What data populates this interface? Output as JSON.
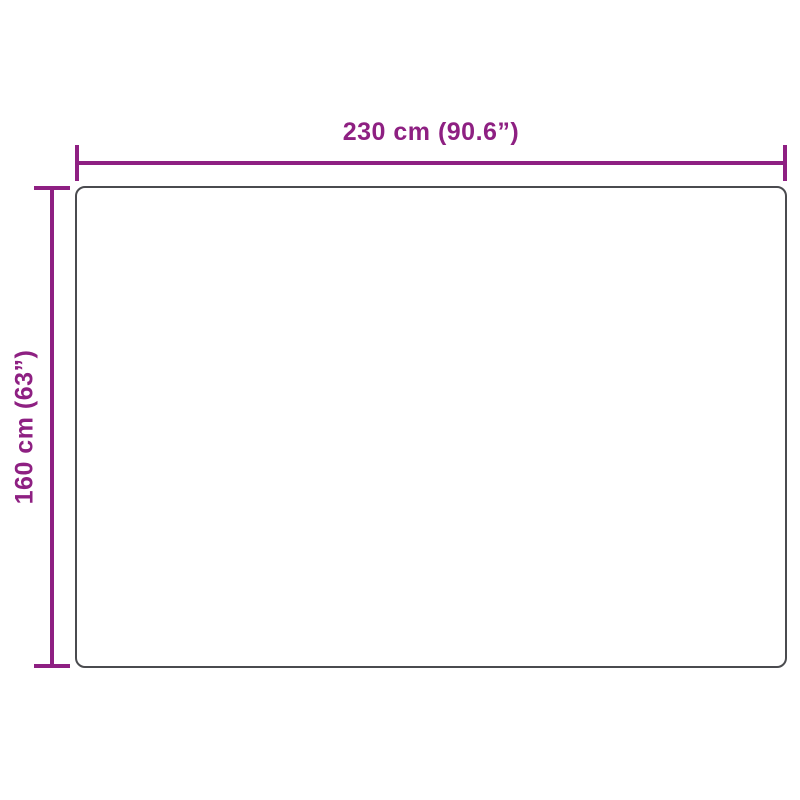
{
  "diagram": {
    "width_label": "230 cm (90.6”)",
    "height_label": "160 cm (63”)",
    "colors": {
      "dimension": "#8e2082",
      "outline": "#4a4b4f",
      "background": "#ffffff"
    }
  }
}
